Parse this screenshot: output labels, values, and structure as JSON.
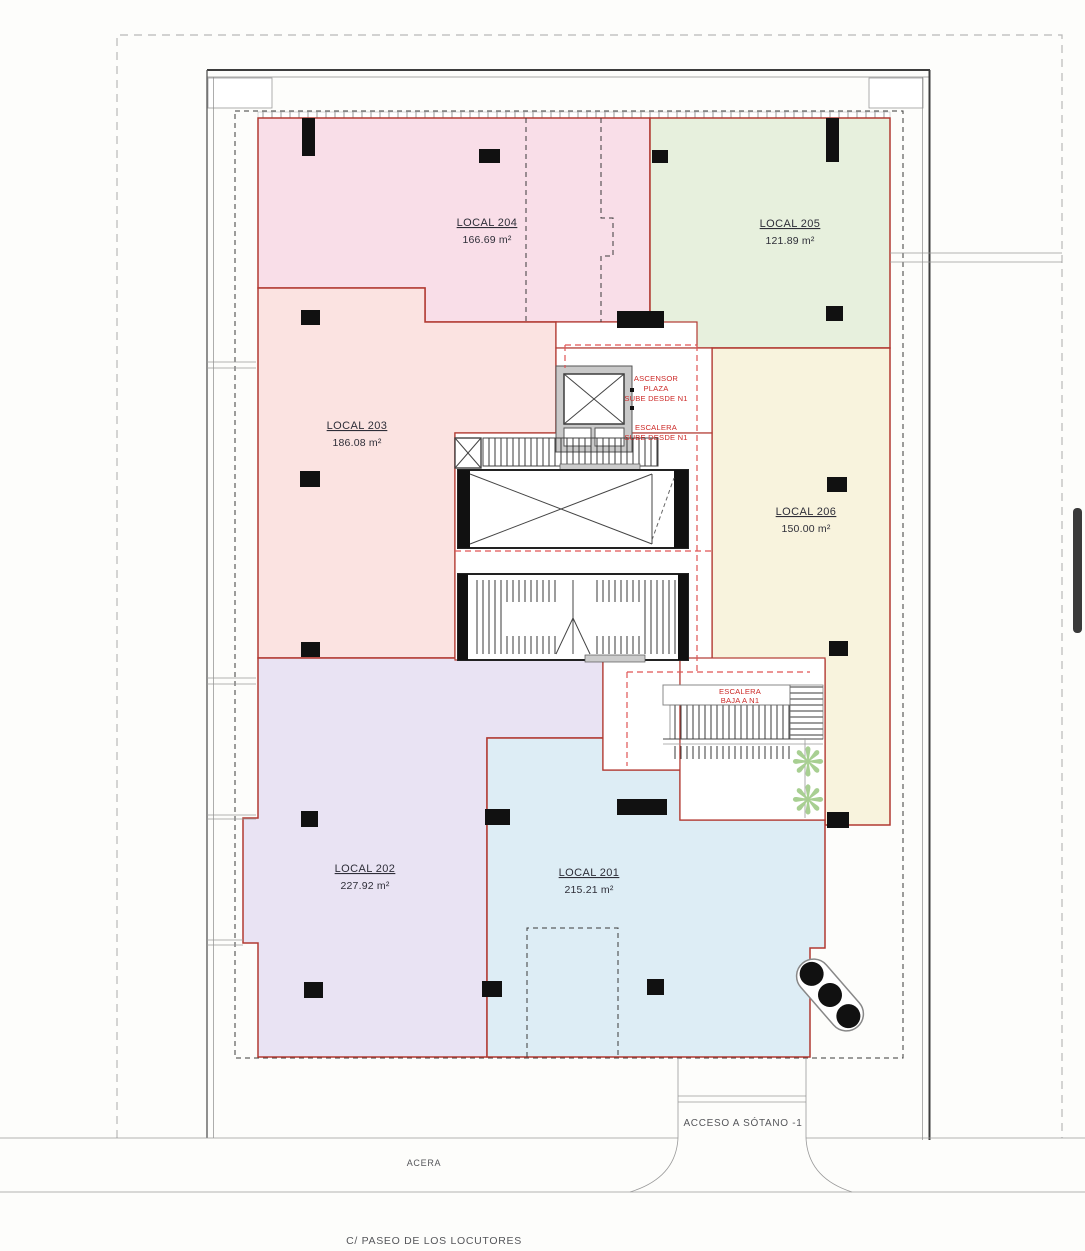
{
  "plan": {
    "locales": [
      {
        "name": "LOCAL 201",
        "area": "215.21 m²",
        "color": "#ddedf5"
      },
      {
        "name": "LOCAL 202",
        "area": "227.92 m²",
        "color": "#e9e3f3"
      },
      {
        "name": "LOCAL 203",
        "area": "186.08 m²",
        "color": "#fbe3e1"
      },
      {
        "name": "LOCAL 204",
        "area": "166.69 m²",
        "color": "#f9dee8"
      },
      {
        "name": "LOCAL 205",
        "area": "121.89 m²",
        "color": "#e7f0dd"
      },
      {
        "name": "LOCAL 206",
        "area": "150.00 m²",
        "color": "#f8f3dd"
      }
    ],
    "core_labels": {
      "ascensor_line1": "ASCENSOR",
      "ascensor_line2": "PLAZA",
      "ascensor_line3": "SUBE DESDE N1",
      "escalera_sube_line1": "ESCALERA",
      "escalera_sube_line2": "SUBE DESDE N1",
      "escalera_baja_line1": "ESCALERA",
      "escalera_baja_line2": "BAJA A N1"
    },
    "site_labels": {
      "acceso": "ACCESO A SÓTANO -1",
      "acera": "ACERA",
      "calle": "C/ PASEO DE LOS LOCUTORES"
    }
  },
  "colors": {
    "boundary": "#b23a32",
    "red_dash": "#e05555",
    "red_text": "#cc2a28",
    "wall_dark": "#3d3d3d",
    "line_gray": "#999999",
    "column_black": "#111111",
    "plant_green": "#a8cf92",
    "scrollbar": "#3a3a3a"
  }
}
